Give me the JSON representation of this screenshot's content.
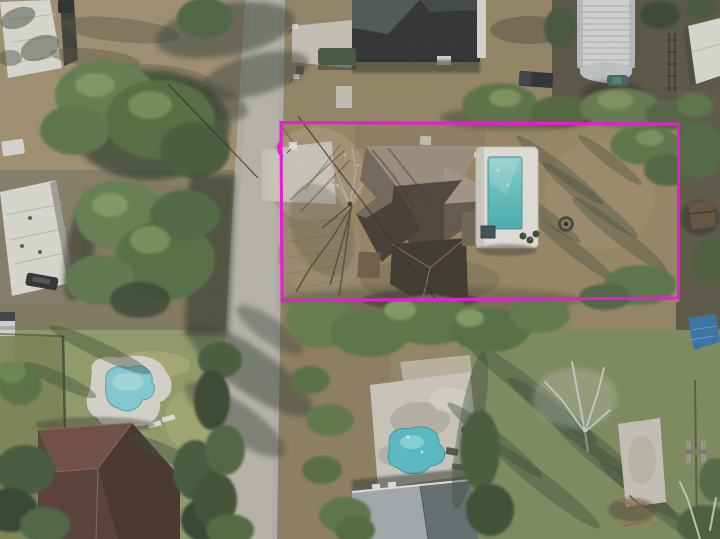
{
  "meta": {
    "type": "aerial-drone-photograph",
    "view": "top-down residential neighborhood",
    "highlight": "magenta rectangle outlining the subject lot containing a house, driveway and rectangular swimming pool"
  },
  "boundary_overlay": {
    "shape": "rectangle",
    "color": "#ea1ad8",
    "stroke_px": 3
  },
  "colors": {
    "boundary": "#ea1ad8",
    "road": "#b5b1a8",
    "concrete": "#cbc6bb",
    "dirt": "#97845f",
    "dirt_light": "#a8916f",
    "lawn": "#93a065",
    "lawn_green": "#7c8b55",
    "tree": "#55713f",
    "shadow": "#2e3a30",
    "pool_deck": "#e9e7e1",
    "pool_water": "#5fc6c6",
    "pool_water_highlight": "#8ad8d4",
    "pool_water_deep": "#3fb0b4",
    "neighbor_pool_left": "#7fd0da",
    "neighbor_pool_center": "#4fc0cc",
    "main_roof_light": "#9b8c79",
    "main_roof_mid": "#6f6354",
    "main_roof_dark": "#453c31",
    "dark_roof": "#23262a",
    "gray_roof": "#8e979c",
    "gray_roof_2": "#a8aeb0",
    "red_roof": "#4e352c",
    "metal_barn": "#d7dadb",
    "white_building": "#e0e1db",
    "tarp": "#2e6fa8",
    "trailer_green": "#3d4f38"
  },
  "scene_objects": [
    "street running vertically on the left with tree shadows",
    "magenta rectangular lot-boundary overlay",
    "subject house with multi-gable brown shingle roof",
    "rectangular swimming pool with white deck and dark spa square",
    "round fire pit in the back yard",
    "concrete driveway with two trash bins",
    "leafless tree casting branch shadows over the driveway",
    "neighboring house with very dark roof at top",
    "white corrugated quonset barn at top right",
    "dark pickup truck and teal car near the barn",
    "dark green utility trailer by the top house",
    "white mobile-home roof at left with parked dark sedan",
    "white RV at the left edge",
    "kidney-shaped pool of the bottom-left neighbor",
    "red-brown hip-roof house at bottom left",
    "free-form pool of the bottom-center neighbor",
    "two gray-roof houses along the bottom",
    "pale leafless tree, concrete pad and wood debris at bottom right",
    "blue tarp and small shed on the right edge",
    "three mailboxes along the street"
  ]
}
